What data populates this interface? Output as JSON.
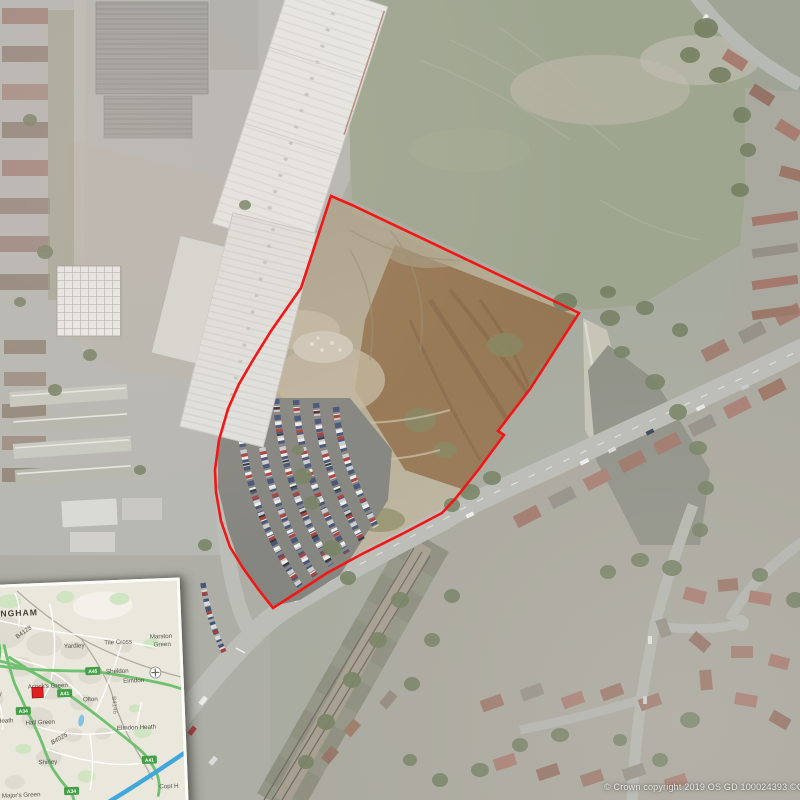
{
  "copyright": {
    "text": "© Crown copyright 2019 OS GD 100024393 ©Get M"
  },
  "site": {
    "boundary_color": "#f21717",
    "boundary_points": "331,196 352,205 579,313 530,389 498,431 504,435 479,469 455,499 442,513 404,533 362,554 327,573 301,590 273,608 258,589 243,568 230,547 221,521 216,492 215,470 219,440 228,409 239,384 253,360 271,331 301,288"
  },
  "inset_map": {
    "city": {
      "text": "MINGHAM"
    },
    "labels": [
      {
        "text": "Tile Cross"
      },
      {
        "text": "Marston"
      },
      {
        "text": "Green"
      },
      {
        "text": "Yardley"
      },
      {
        "text": "Sheldon"
      },
      {
        "text": "Elmdon"
      },
      {
        "text": "Acock's Green"
      },
      {
        "text": "Olton"
      },
      {
        "text": "Heath"
      },
      {
        "text": "Hall Green"
      },
      {
        "text": "Elmdon Heath"
      },
      {
        "text": "Shirley"
      },
      {
        "text": "Major's Green"
      },
      {
        "text": "Copt H"
      },
      {
        "text": "Monkspath"
      },
      {
        "text": "ey"
      },
      {
        "text": "B4128"
      },
      {
        "text": "B4025"
      },
      {
        "text": "B4146"
      }
    ],
    "badges": [
      {
        "text": "4540"
      },
      {
        "text": "A45"
      },
      {
        "text": "A41"
      },
      {
        "text": "A34"
      },
      {
        "text": "A41"
      },
      {
        "text": "A34"
      }
    ],
    "colors": {
      "a_road": "#6fc170",
      "motorway": "#41a7db",
      "marker": "#e02020",
      "badge": "#43a047"
    }
  }
}
